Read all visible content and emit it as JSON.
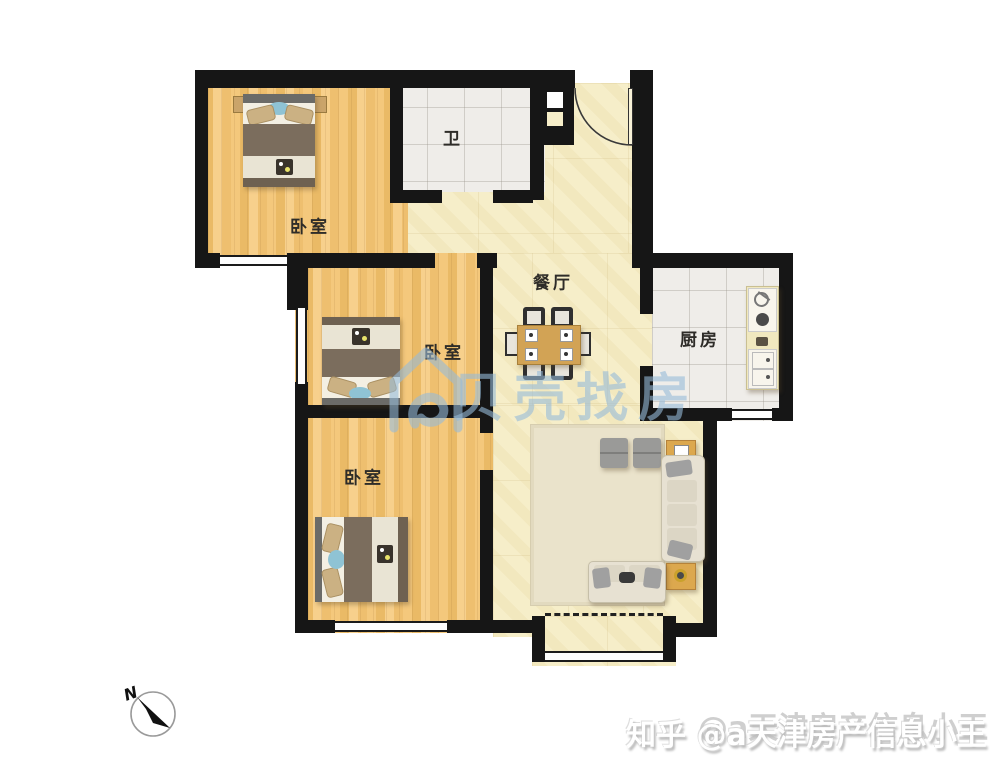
{
  "rooms": {
    "bedroom_top": {
      "label": "卧室"
    },
    "bedroom_middle": {
      "label": "卧室"
    },
    "bedroom_bottom": {
      "label": "卧室"
    },
    "bathroom": {
      "label": "卫"
    },
    "dining": {
      "label": "餐厅"
    },
    "kitchen": {
      "label": "厨房"
    }
  },
  "watermarks": {
    "beike": {
      "text": "贝壳找房",
      "color": "#9abad8"
    },
    "zhihu": {
      "text": "知乎 @a天津房产信息小王",
      "ghost_text": "@a天津房产信息小王"
    }
  },
  "compass": {
    "label": "N"
  },
  "colors": {
    "wall": "#161616",
    "wood_floor": "#f0c375",
    "marble_floor": "#f6eec9",
    "tile_floor": "#efede9",
    "bed_blanket": "#7b6d5d",
    "bed_accent_blue": "#8fc3d4",
    "table_wood": "#d2a355",
    "sofa_cream": "#e7e1d2",
    "counter": "#f0e8bf"
  }
}
